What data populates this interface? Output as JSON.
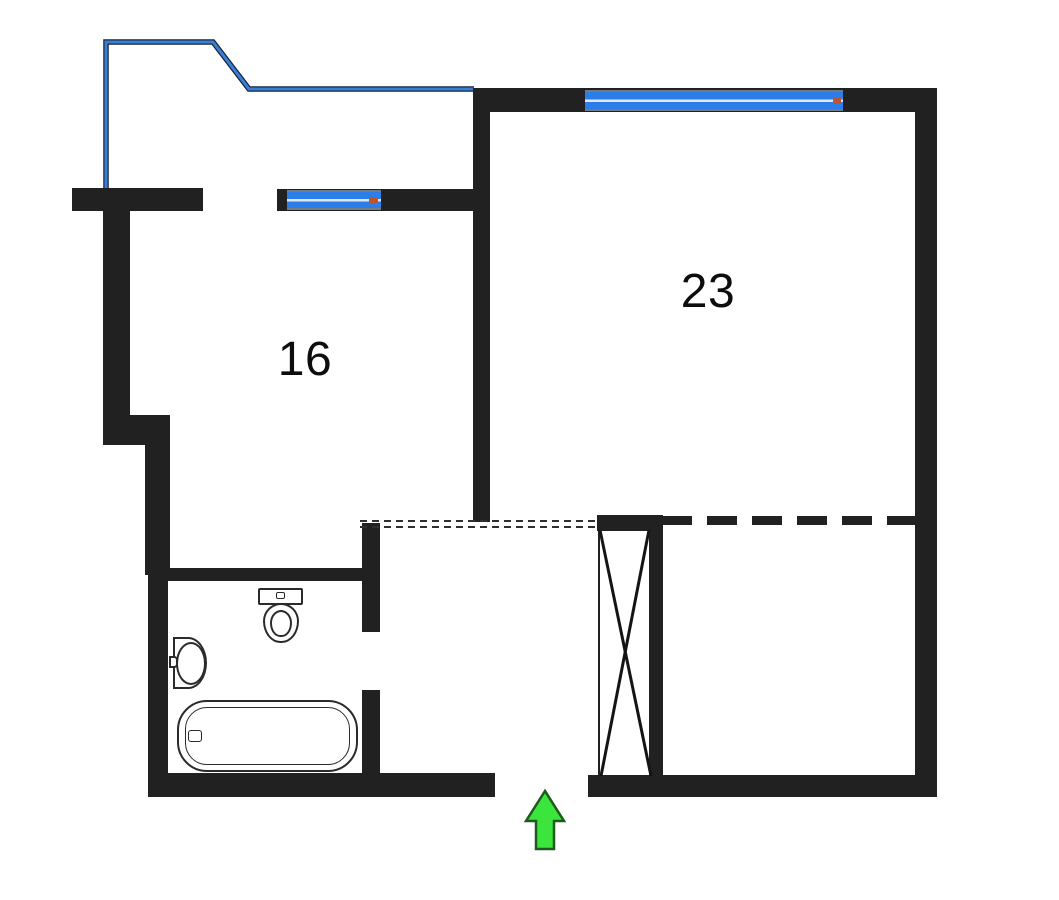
{
  "plan": {
    "kind": "apartment-floor-plan",
    "entrance_marker": "green-up-arrow"
  },
  "rooms": [
    {
      "id": "room-16",
      "label": "16"
    },
    {
      "id": "room-23",
      "label": "23"
    }
  ],
  "fixtures": {
    "bathroom": [
      "toilet",
      "sink",
      "bathtub"
    ],
    "hall": [
      "wardrobe-crossed-box"
    ]
  },
  "colors": {
    "wall": "#212121",
    "window_blue": "#2b7de9",
    "window_divider": "#e3e7ec",
    "balcony_blue": "#3b7fd4",
    "balcony_edge": "#16253c",
    "arrow_green": "#3ce53c",
    "arrow_outline": "#1d5a1d",
    "fixture_outline": "#2b2b2b",
    "label_text": "#0d0d0d"
  }
}
